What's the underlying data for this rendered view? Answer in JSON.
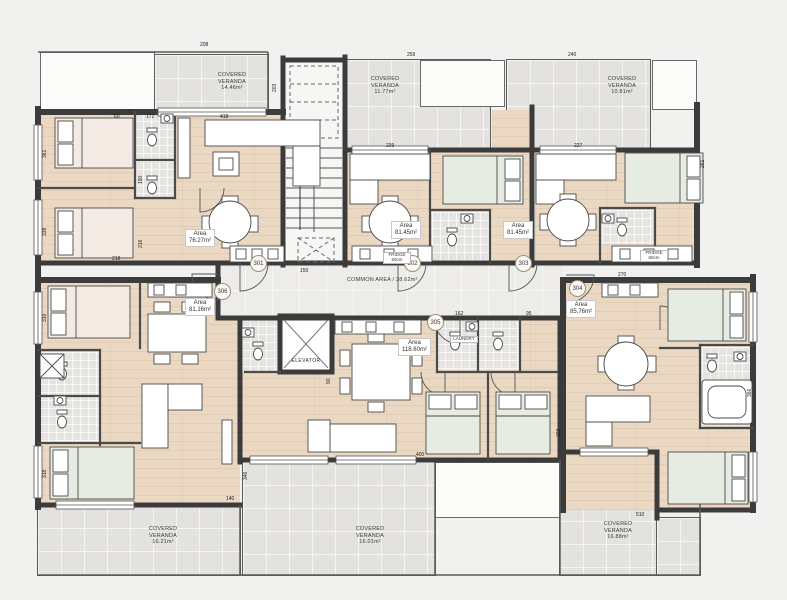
{
  "plan": {
    "common_area_label": "COMMON AREA / 38.62m²",
    "elevator_label": "ELEVATOR"
  },
  "colors": {
    "wall": "#3b3b3b",
    "floor_wood": "#ead8c3",
    "veranda_tile": "#e3e2de",
    "corridor_tile": "#edece9",
    "bath_tile": "#e6e4e0",
    "bed_green": "#e7ece3",
    "bed_pink": "#f3eae4"
  },
  "apartments": [
    {
      "number": "301",
      "area_title": "Area",
      "area_value": "76.27m²"
    },
    {
      "number": "302",
      "area_title": "Area",
      "area_value": "81.45m²"
    },
    {
      "number": "303",
      "area_title": "Area",
      "area_value": "81.45m²"
    },
    {
      "number": "304",
      "area_title": "Area",
      "area_value": "85.76m²"
    },
    {
      "number": "305",
      "area_title": "Area",
      "area_value": "118.60m²"
    },
    {
      "number": "306",
      "area_title": "Area",
      "area_value": "81.16m²"
    }
  ],
  "verandas": [
    {
      "title": "COVERED VERANDA",
      "area": "14.46m²"
    },
    {
      "title": "COVERED VERANDA",
      "area": "11.77m²"
    },
    {
      "title": "COVERED VERANDA",
      "area": "10.81m²"
    },
    {
      "title": "COVERED VERANDA",
      "area": "16.21m²"
    },
    {
      "title": "COVERED VERANDA",
      "area": "16.01m²"
    },
    {
      "title": "COVERED VERANDA",
      "area": "16.88m²"
    }
  ],
  "dimensions": [
    {
      "t": "208",
      "x": 200,
      "y": 42
    },
    {
      "t": "259",
      "x": 407,
      "y": 52
    },
    {
      "t": "240",
      "x": 568,
      "y": 52
    },
    {
      "t": "60",
      "x": 114,
      "y": 114
    },
    {
      "t": "172",
      "x": 146,
      "y": 114
    },
    {
      "t": "418",
      "x": 220,
      "y": 114
    },
    {
      "t": "203",
      "x": 272,
      "y": 92,
      "v": true
    },
    {
      "t": "361",
      "x": 42,
      "y": 158,
      "v": true
    },
    {
      "t": "338",
      "x": 42,
      "y": 236,
      "v": true
    },
    {
      "t": "190",
      "x": 138,
      "y": 184,
      "v": true
    },
    {
      "t": "216",
      "x": 138,
      "y": 248,
      "v": true
    },
    {
      "t": "218",
      "x": 112,
      "y": 256
    },
    {
      "t": "239",
      "x": 386,
      "y": 143
    },
    {
      "t": "227",
      "x": 574,
      "y": 143
    },
    {
      "t": "261",
      "x": 700,
      "y": 168,
      "v": true
    },
    {
      "t": "150",
      "x": 300,
      "y": 268
    },
    {
      "t": "162",
      "x": 455,
      "y": 311
    },
    {
      "t": "95",
      "x": 526,
      "y": 311
    },
    {
      "t": "270",
      "x": 618,
      "y": 272
    },
    {
      "t": "310",
      "x": 42,
      "y": 322,
      "v": true
    },
    {
      "t": "318",
      "x": 42,
      "y": 478,
      "v": true
    },
    {
      "t": "90",
      "x": 326,
      "y": 384,
      "v": true
    },
    {
      "t": "346",
      "x": 243,
      "y": 480,
      "v": true
    },
    {
      "t": "400",
      "x": 416,
      "y": 452
    },
    {
      "t": "303",
      "x": 556,
      "y": 437,
      "v": true
    },
    {
      "t": "366",
      "x": 747,
      "y": 397,
      "v": true
    },
    {
      "t": "140",
      "x": 226,
      "y": 496
    },
    {
      "t": "510",
      "x": 636,
      "y": 512
    }
  ],
  "appliance_labels": [
    {
      "t": "FRIDGE 60cm",
      "x": 383,
      "y": 252
    },
    {
      "t": "FRIDGE 60cm",
      "x": 640,
      "y": 250
    },
    {
      "t": "LAUNDRY",
      "x": 450,
      "y": 336
    }
  ]
}
